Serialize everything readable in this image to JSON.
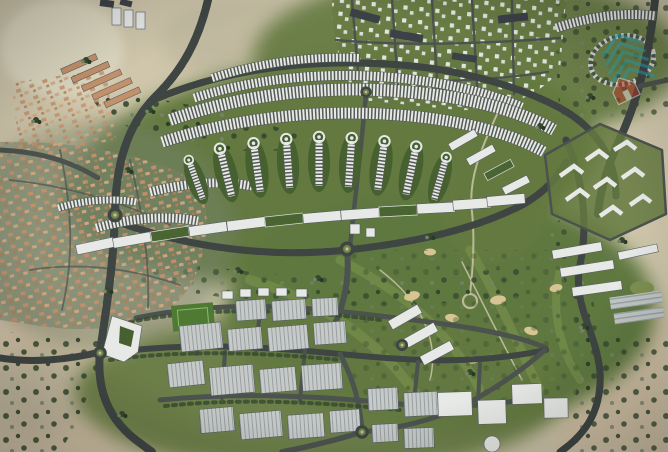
{
  "image": {
    "kind": "aerial-masterplan-render",
    "width": 668,
    "height": 452,
    "visible_text": "none"
  },
  "watermark": {
    "icon": "property-portal-house-chevron-logo-icon",
    "opacity": 0.5
  },
  "palette": {
    "desert": "#cfc6ab",
    "desertWarm": "#d2c0a4",
    "desertLight": "#ddd8c0",
    "desertDark": "#b2ae95",
    "scrub": "#76836a",
    "tree": "#35482f",
    "treeDark": "#283a25",
    "green": "#64793f",
    "greenDark": "#47602f",
    "greenLight": "#7d9150",
    "golf": "#5f7840",
    "golfStripe": "#89a055",
    "sand": "#d6c493",
    "pathSand": "#cbc5a6",
    "road": "#3f4543",
    "roadMinor": "#4c524e",
    "dash": "#d9dcd6",
    "bldgWhite": "#e7e9e7",
    "bldgShadow": "#585f63",
    "roofDark": "#3c4148",
    "roofGreen": "#4a6532",
    "villaRoof": "#c3906a",
    "villaRoofLight": "#d2a77f",
    "warehouse": "#c6cac9",
    "warehouseLine": "#9aa0a1",
    "field": "#4e7a33",
    "logoTeal": "#23a7c0",
    "logoRed": "#c0392b"
  },
  "regions": [
    {
      "id": "desert-terrain"
    },
    {
      "id": "west-villa-district"
    },
    {
      "id": "northwest-apartment-rows"
    },
    {
      "id": "north-villa-grid"
    },
    {
      "id": "central-townhouse-arcs"
    },
    {
      "id": "teardrop-residential-clusters"
    },
    {
      "id": "apartment-slab-arc"
    },
    {
      "id": "east-zigzag-apartment-block"
    },
    {
      "id": "east-linear-apartments"
    },
    {
      "id": "golf-course"
    },
    {
      "id": "industrial-warehouse-district"
    },
    {
      "id": "ring-roads-and-roundabouts"
    }
  ]
}
